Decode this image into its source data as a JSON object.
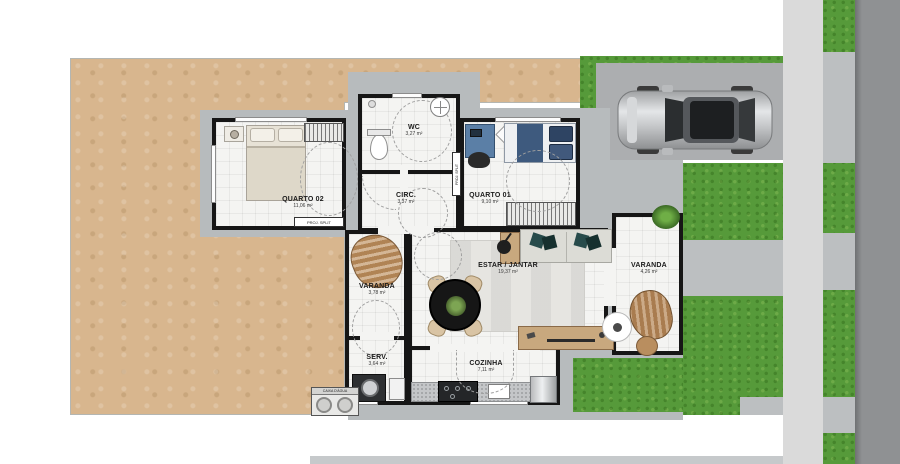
{
  "plan": {
    "rooms": {
      "quarto02": {
        "name": "QUARTO 02",
        "area": "11,06 m²"
      },
      "wc": {
        "name": "WC",
        "area": "3,27 m²"
      },
      "circ": {
        "name": "CIRC.",
        "area": "3,37 m²"
      },
      "quarto01": {
        "name": "QUARTO 01",
        "area": "9,10 m²"
      },
      "estar": {
        "name": "ESTAR / JANTAR",
        "area": "19,37 m²"
      },
      "varanda_esq": {
        "name": "VARANDA",
        "area": "3,78 m²"
      },
      "serv": {
        "name": "SERV.",
        "area": "3,64 m²"
      },
      "cozinha": {
        "name": "COZINHA",
        "area": "7,11 m²"
      },
      "varanda_dir": {
        "name": "VARANDA",
        "area": "4,26 m²"
      }
    },
    "annotations": {
      "proj_split_1": "PROJ. SPLIT",
      "proj_split_2": "PROJ. SPLIT",
      "caixa_dagua": "CAIXA D'ÁGUA"
    },
    "colors": {
      "sand": "#d8b68e",
      "grass": "#569a3a",
      "pad": "#b7bbbd",
      "parking": "#acaeb0",
      "sidewalk": "#dadada",
      "street": "#8f9193",
      "wall": "#161616",
      "floor": "#f4f4f2",
      "wood": "#c8a87e",
      "bed_blue": "#3e5a7e"
    }
  }
}
